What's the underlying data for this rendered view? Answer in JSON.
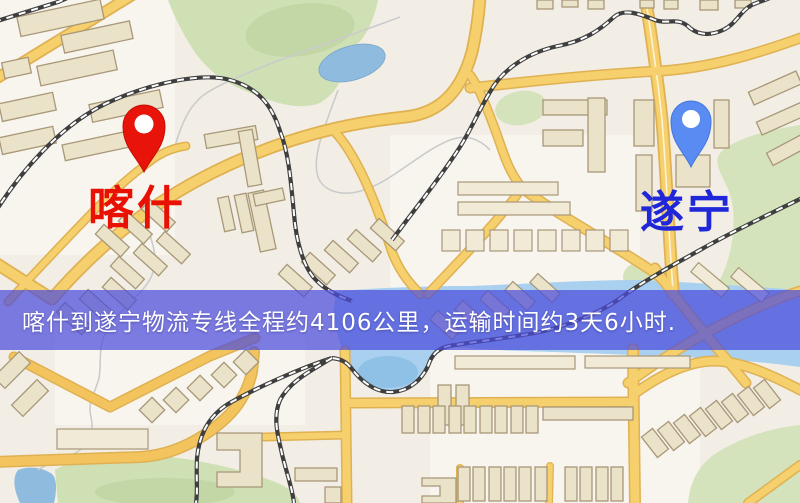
{
  "page": {
    "type": "logistics-route-map-image",
    "width_px": 800,
    "height_px": 503
  },
  "origin": {
    "label": "喀什",
    "pin_color": "#e8140a",
    "label_color": "#e81104"
  },
  "destination": {
    "label": "遂宁",
    "pin_color": "#5a8bf2",
    "label_color": "#1f27d8"
  },
  "banner": {
    "text": "喀什到遂宁物流专线全程约4106公里，运输时间约3天6小时.",
    "background_color": "#4b4cdc",
    "background_opacity": 0.72,
    "text_color": "#ffffff"
  },
  "route": {
    "from": "喀什",
    "to": "遂宁",
    "service": "物流专线",
    "distance_km": "4106",
    "duration": "3天6小时"
  },
  "map_colors": {
    "background": "#f2eee6",
    "road_fill": "#f6d06c",
    "road_casing": "#dfb152",
    "building_fill": "#eae3c9",
    "green_area": "#cfe0b4",
    "water": "#a9d0ee",
    "railway": "#3f3f3f"
  }
}
